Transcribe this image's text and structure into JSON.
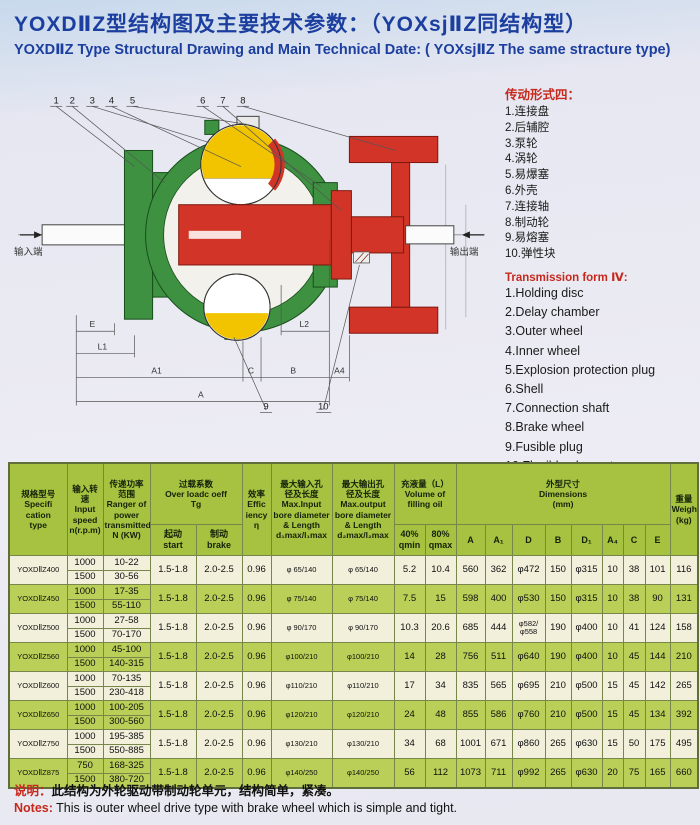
{
  "page": {
    "title_zh": "YOXDⅡZ型结构图及主要技术参数：（YOXsjⅡZ同结构型）",
    "title_en": "YOXDⅡZ Type Structural Drawing and Main Technical Date: ( YOXsjⅡZ The same stracture type)"
  },
  "drawing": {
    "input_end_label": "输入端",
    "output_end_label": "输出端",
    "callouts": [
      "1",
      "2",
      "3",
      "4",
      "5",
      "6",
      "7",
      "8",
      "9",
      "10"
    ],
    "dim_labels": {
      "e": "E",
      "l1": "L1",
      "a1": "A1",
      "c": "C",
      "b": "B",
      "a4": "A4",
      "a": "A",
      "l2": "L2"
    },
    "colors": {
      "housing_green": "#3d9140",
      "rotor_red": "#d23527",
      "oil_yellow": "#f2c400"
    }
  },
  "legend_zh": {
    "title": "传动形式四：",
    "items": [
      "1.连接盘",
      "2.后辅腔",
      "3.泵轮",
      "4.涡轮",
      "5.易爆塞",
      "6.外壳",
      "7.连接轴",
      "8.制动轮",
      "9.易熔塞",
      "10.弹性块"
    ]
  },
  "legend_en": {
    "title": "Transmission form Ⅳ:",
    "items": [
      "1.Holding disc",
      "2.Delay chamber",
      "3.Outer wheel",
      "4.Inner wheel",
      "5.Explosion protection plug",
      "6.Shell",
      "7.Connection shaft",
      "8.Brake wheel",
      "9.Fusible plug",
      "10.Flexible element"
    ]
  },
  "table": {
    "head": {
      "type": [
        "规格型号",
        "Specifi cation",
        "type"
      ],
      "speed": [
        "输入转速",
        "Input",
        "speed",
        "n(r.p.m)"
      ],
      "power": [
        "传递功率",
        "范围",
        "Ranger of",
        "power",
        "transmitted",
        "N (KW)"
      ],
      "overload": [
        "过载系数",
        "Over loadc oeff",
        "Tg"
      ],
      "eff": [
        "效率",
        "Effic",
        "iency",
        "η"
      ],
      "in_bore": [
        "最大输入孔",
        "径及长度",
        "Max.Input",
        "bore diameter",
        "& Length",
        "d₁max/l₁max"
      ],
      "out_bore": [
        "最大输出孔",
        "径及长度",
        "Max.output",
        "bore diameter",
        "& Length",
        "d₂max/l₂max"
      ],
      "fill": [
        "充液量（L）",
        "Volume of",
        "filling oil"
      ],
      "dims": [
        "外型尺寸",
        "Dimensions",
        "(mm)"
      ],
      "weight": [
        "重量",
        "Weight",
        "(kg)"
      ],
      "sub": [
        [
          "起动",
          "start"
        ],
        [
          "制动",
          "brake"
        ],
        [
          "40%",
          "qmin"
        ],
        [
          "80%",
          "qmax"
        ],
        [
          "A"
        ],
        [
          "A₁"
        ],
        [
          "D"
        ],
        [
          "B"
        ],
        [
          "D₁"
        ],
        [
          "A₄"
        ],
        [
          "C"
        ],
        [
          "E"
        ]
      ]
    },
    "rows": [
      {
        "type": "YOXDⅡZ400",
        "speeds": [
          {
            "n": "1000",
            "power": "10-22"
          },
          {
            "n": "1500",
            "power": "30-56"
          }
        ],
        "start": "1.5-1.8",
        "brake": "2.0-2.5",
        "eff": "0.96",
        "in_bore": "φ 65/140",
        "out_bore": "φ 65/140",
        "q40": "5.2",
        "q80": "10.4",
        "A": "560",
        "A1": "362",
        "D": "φ472",
        "B": "150",
        "D1": "φ315",
        "A4": "10",
        "C": "38",
        "E": "101",
        "wt": "116"
      },
      {
        "type": "YOXDⅡZ450",
        "speeds": [
          {
            "n": "1000",
            "power": "17-35"
          },
          {
            "n": "1500",
            "power": "55-110"
          }
        ],
        "start": "1.5-1.8",
        "brake": "2.0-2.5",
        "eff": "0.96",
        "in_bore": "φ 75/140",
        "out_bore": "φ 75/140",
        "q40": "7.5",
        "q80": "15",
        "A": "598",
        "A1": "400",
        "D": "φ530",
        "B": "150",
        "D1": "φ315",
        "A4": "10",
        "C": "38",
        "E": "90",
        "wt": "131"
      },
      {
        "type": "YOXDⅡZ500",
        "speeds": [
          {
            "n": "1000",
            "power": "27-58"
          },
          {
            "n": "1500",
            "power": "70-170"
          }
        ],
        "start": "1.5-1.8",
        "brake": "2.0-2.5",
        "eff": "0.96",
        "in_bore": "φ 90/170",
        "out_bore": "φ 90/170",
        "q40": "10.3",
        "q80": "20.6",
        "A": "685",
        "A1": "444",
        "D": "φ582/φ558",
        "B": "190",
        "D1": "φ400",
        "A4": "10",
        "C": "41",
        "E": "124",
        "wt": "158"
      },
      {
        "type": "YOXDⅡZ560",
        "speeds": [
          {
            "n": "1000",
            "power": "45-100"
          },
          {
            "n": "1500",
            "power": "140-315"
          }
        ],
        "start": "1.5-1.8",
        "brake": "2.0-2.5",
        "eff": "0.96",
        "in_bore": "φ100/210",
        "out_bore": "φ100/210",
        "q40": "14",
        "q80": "28",
        "A": "756",
        "A1": "511",
        "D": "φ640",
        "B": "190",
        "D1": "φ400",
        "A4": "10",
        "C": "45",
        "E": "144",
        "wt": "210"
      },
      {
        "type": "YOXDⅡZ600",
        "speeds": [
          {
            "n": "1000",
            "power": "70-135"
          },
          {
            "n": "1500",
            "power": "230-418"
          }
        ],
        "start": "1.5-1.8",
        "brake": "2.0-2.5",
        "eff": "0.96",
        "in_bore": "φ110/210",
        "out_bore": "φ110/210",
        "q40": "17",
        "q80": "34",
        "A": "835",
        "A1": "565",
        "D": "φ695",
        "B": "210",
        "D1": "φ500",
        "A4": "15",
        "C": "45",
        "E": "142",
        "wt": "265"
      },
      {
        "type": "YOXDⅡZ650",
        "speeds": [
          {
            "n": "1000",
            "power": "100-205"
          },
          {
            "n": "1500",
            "power": "300-560"
          }
        ],
        "start": "1.5-1.8",
        "brake": "2.0-2.5",
        "eff": "0.96",
        "in_bore": "φ120/210",
        "out_bore": "φ120/210",
        "q40": "24",
        "q80": "48",
        "A": "855",
        "A1": "586",
        "D": "φ760",
        "B": "210",
        "D1": "φ500",
        "A4": "15",
        "C": "45",
        "E": "134",
        "wt": "392"
      },
      {
        "type": "YOXDⅡZ750",
        "speeds": [
          {
            "n": "1000",
            "power": "195-385"
          },
          {
            "n": "1500",
            "power": "550-885"
          }
        ],
        "start": "1.5-1.8",
        "brake": "2.0-2.5",
        "eff": "0.96",
        "in_bore": "φ130/210",
        "out_bore": "φ130/210",
        "q40": "34",
        "q80": "68",
        "A": "1001",
        "A1": "671",
        "D": "φ860",
        "B": "265",
        "D1": "φ630",
        "A4": "15",
        "C": "50",
        "E": "175",
        "wt": "495"
      },
      {
        "type": "YOXDⅡZ875",
        "speeds": [
          {
            "n": "750",
            "power": "168-325"
          },
          {
            "n": "1500",
            "power": "380-720"
          }
        ],
        "start": "1.5-1.8",
        "brake": "2.0-2.5",
        "eff": "0.96",
        "in_bore": "φ140/250",
        "out_bore": "φ140/250",
        "q40": "56",
        "q80": "112",
        "A": "1073",
        "A1": "711",
        "D": "φ992",
        "B": "265",
        "D1": "φ630",
        "A4": "20",
        "C": "75",
        "E": "165",
        "wt": "660"
      }
    ]
  },
  "notes": {
    "label_zh": "说明：",
    "text_zh": "此结构为外轮驱动带制动轮单元，结构简单，紧凑。",
    "label_en": "Notes:",
    "text_en": "This is outer wheel drive type with brake wheel which is simple and tight."
  },
  "colors": {
    "title_blue": "#1c3f9f",
    "accent_red": "#c6281c",
    "header_green": "#a7c140",
    "row_green": "#b9cf58",
    "row_cream": "#f2efdb"
  }
}
